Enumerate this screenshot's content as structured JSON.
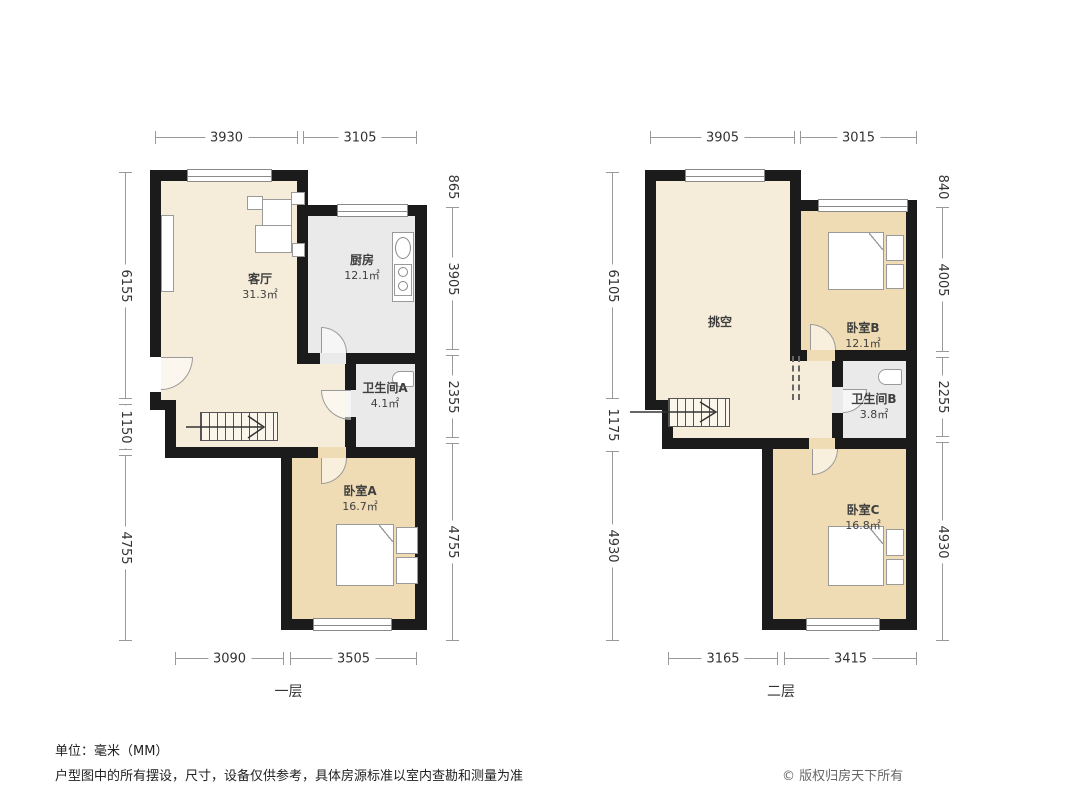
{
  "colors": {
    "wall": "#1b1b1b",
    "cream": "#f5edda",
    "tan": "#f0dcb4",
    "service": "#eaeaea"
  },
  "floor1": {
    "title": "一层",
    "rooms": {
      "living": {
        "label": "客厅",
        "area": "31.3㎡"
      },
      "kitchen": {
        "label": "厨房",
        "area": "12.1㎡"
      },
      "bath_a": {
        "label": "卫生间A",
        "area": "4.1㎡"
      },
      "bed_a": {
        "label": "卧室A",
        "area": "16.7㎡"
      }
    },
    "dims": {
      "top": [
        "3930",
        "3105"
      ],
      "bottom": [
        "3090",
        "3505"
      ],
      "left": [
        "6155",
        "1150",
        "4755"
      ],
      "right": [
        "865",
        "3905",
        "2355",
        "4755"
      ]
    }
  },
  "floor2": {
    "title": "二层",
    "rooms": {
      "void": {
        "label": "挑空",
        "area": ""
      },
      "bed_b": {
        "label": "卧室B",
        "area": "12.1㎡"
      },
      "bath_b": {
        "label": "卫生间B",
        "area": "3.8㎡"
      },
      "bed_c": {
        "label": "卧室C",
        "area": "16.8㎡"
      }
    },
    "dims": {
      "top": [
        "3905",
        "3015"
      ],
      "bottom": [
        "3165",
        "3415"
      ],
      "left": [
        "6105",
        "1175",
        "4930"
      ],
      "right": [
        "840",
        "4005",
        "2255",
        "4930"
      ]
    }
  },
  "footer": {
    "unit_note": "单位：毫米（MM）",
    "disclaimer": "户型图中的所有摆设，尺寸，设备仅供参考，具体房源标准以室内查勘和测量为准",
    "copyright": "© 版权归房天下所有"
  }
}
